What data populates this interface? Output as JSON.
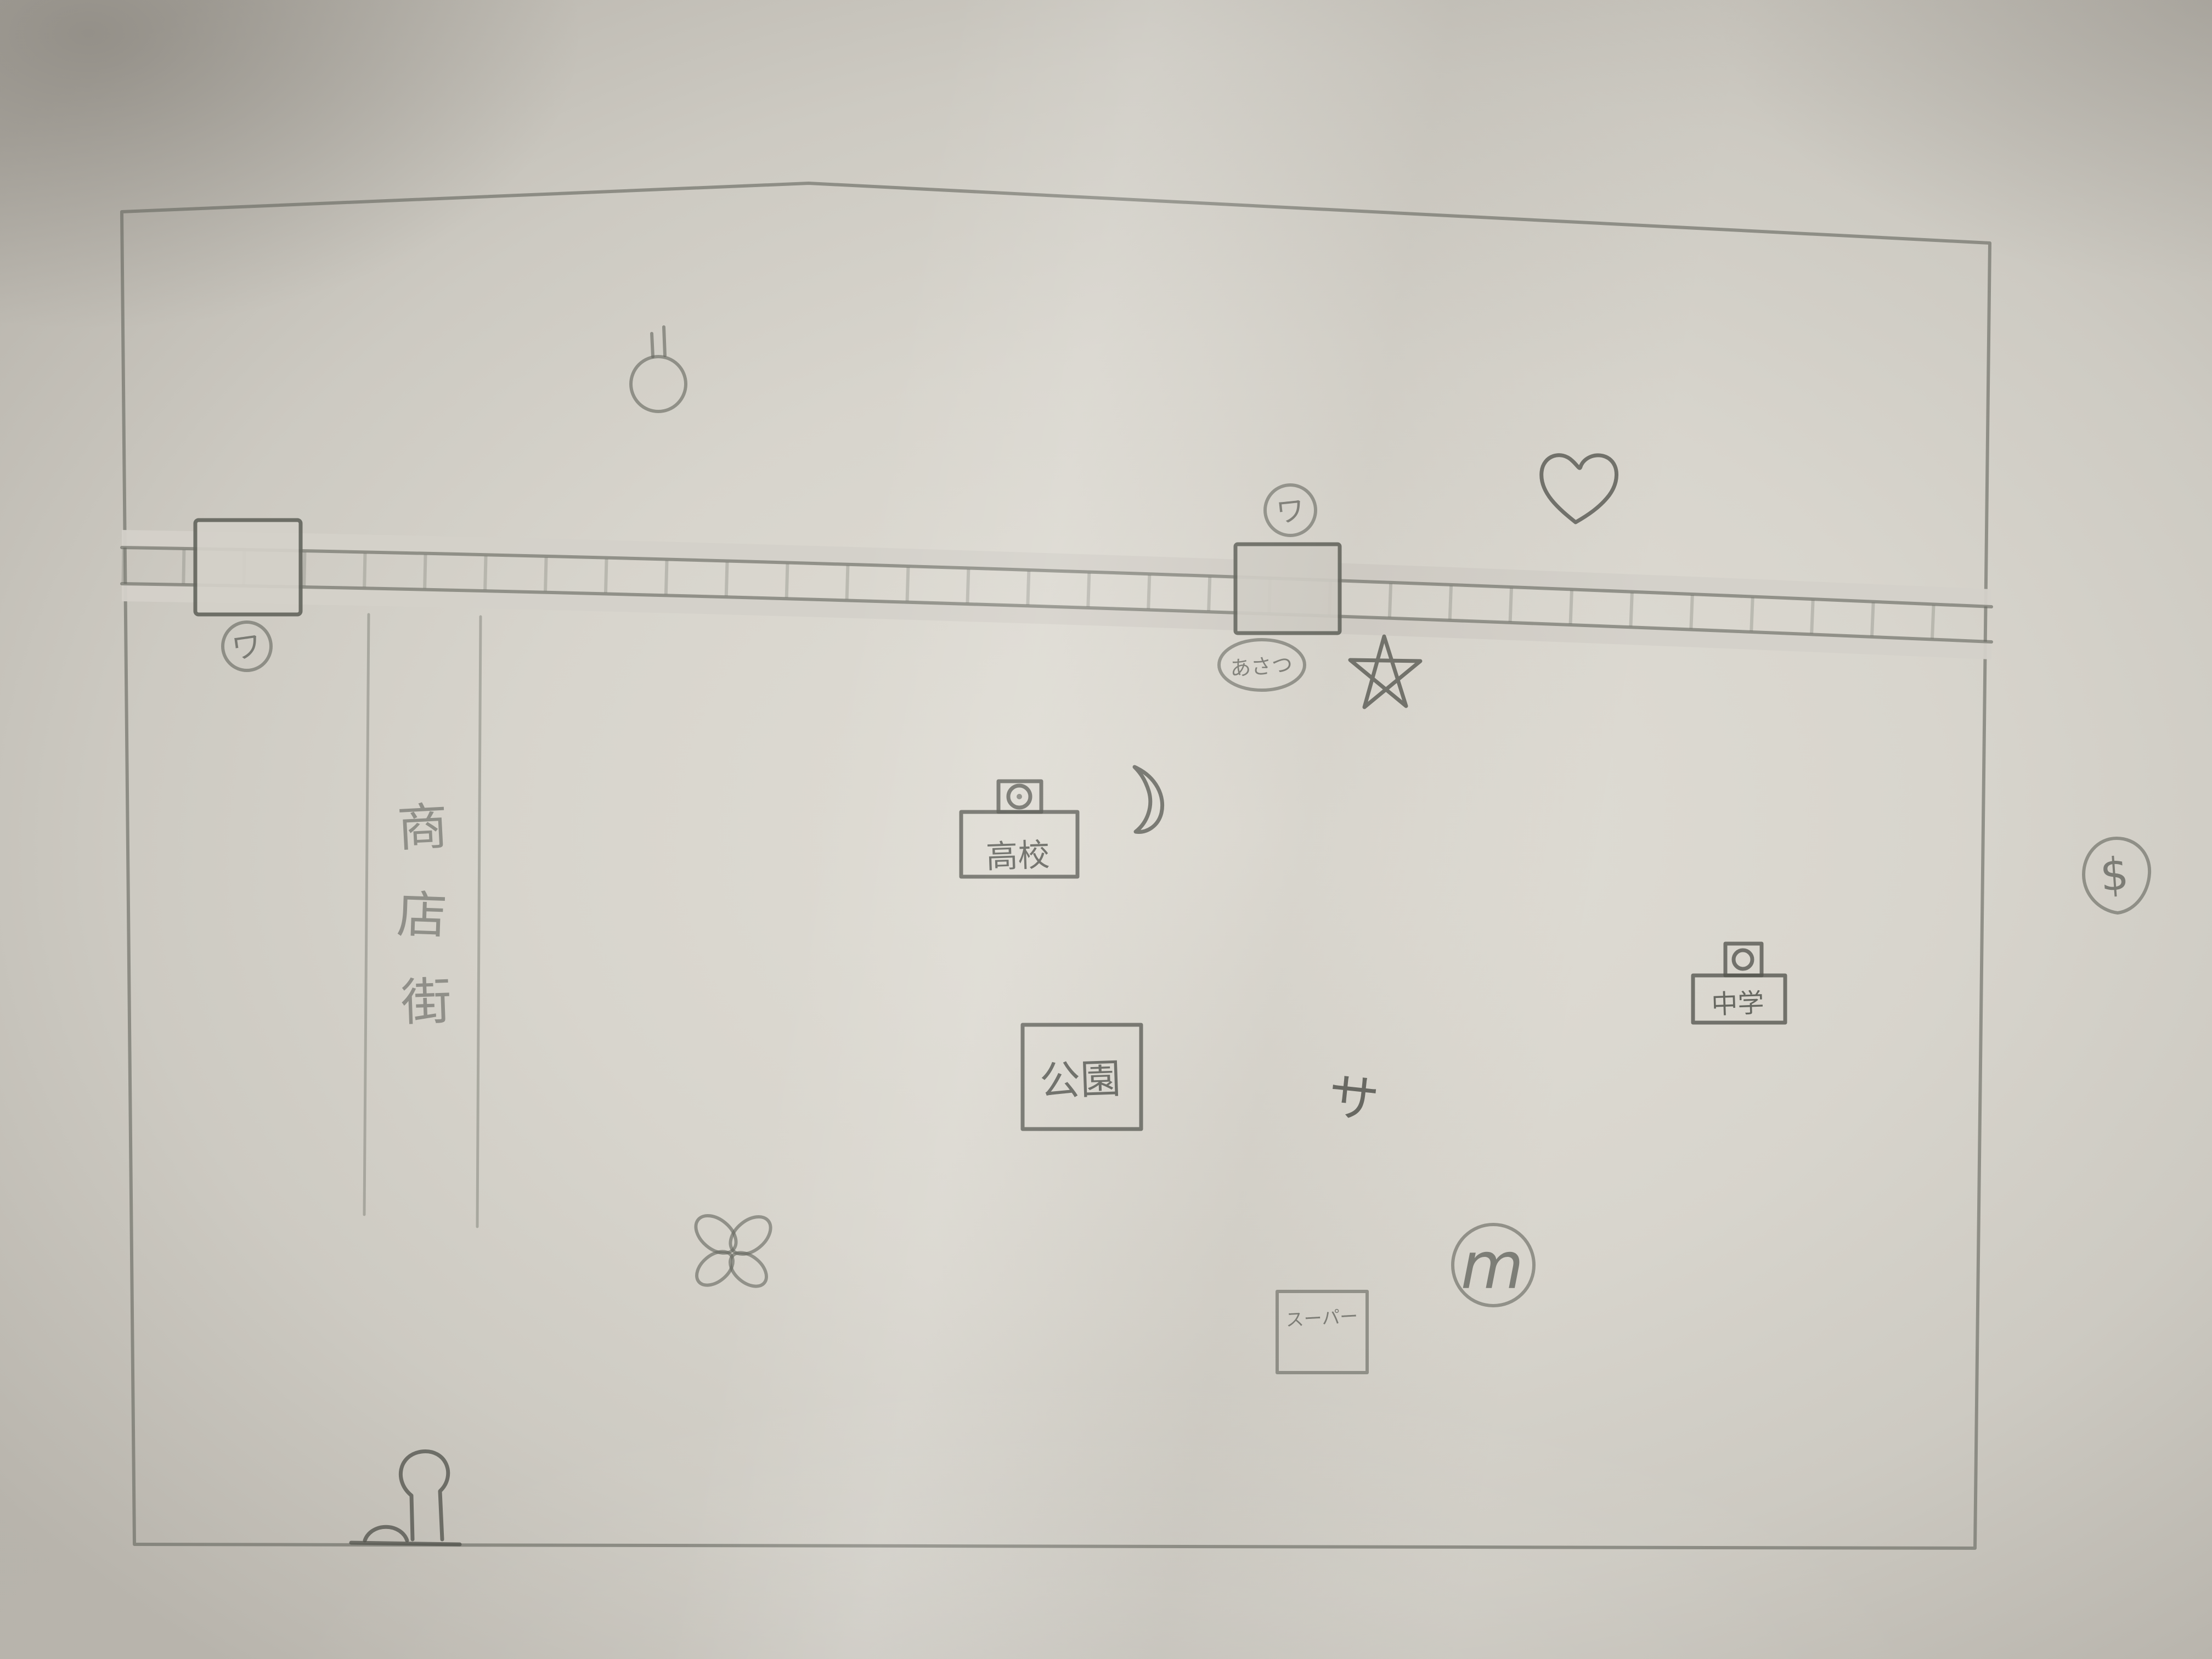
{
  "labels": {
    "station_left_badge": "ワ",
    "station_center_badge": "ワ",
    "station_center_name": "あさつ",
    "shopping_street": [
      "商",
      "店",
      "街"
    ],
    "high_school": "高校",
    "park": "公園",
    "middle_school": "中学",
    "supermarket": "スーパー",
    "sa_mark": "サ",
    "m_mark": "m",
    "dollar_mark": "$"
  },
  "icons": {
    "balloon": "balloon-doodle",
    "heart": "heart-doodle",
    "star": "five-point-star-doodle",
    "moon": "crescent-moon-doodle",
    "flower": "four-petal-flower-doodle",
    "slide": "slide-and-tree-doodle",
    "railway": "railway-track-with-ties"
  },
  "colors": {
    "pencil": "#53554e",
    "paper": "#d6d3cb"
  }
}
